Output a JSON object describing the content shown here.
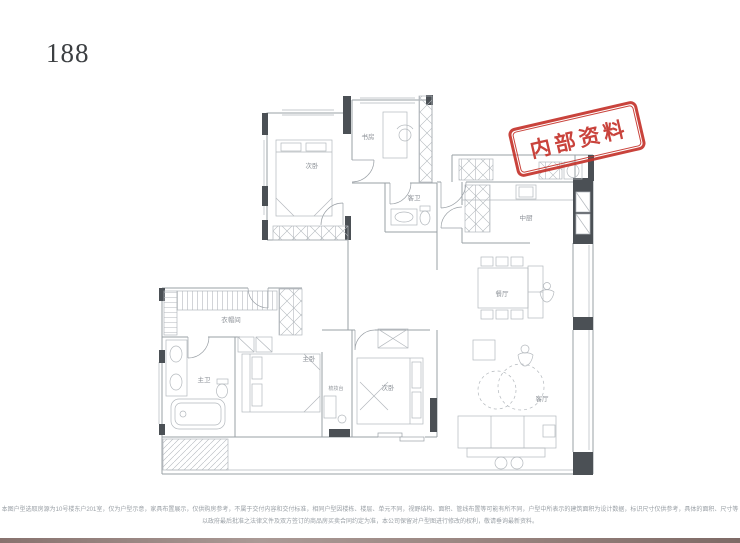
{
  "header": {
    "plan_number": "188"
  },
  "stamp": {
    "text": "内部资料",
    "color": "#c5342c"
  },
  "rooms": {
    "bedroom_top": "次卧",
    "study": "书房",
    "guest_bath": "客卫",
    "kitchen": "中厨",
    "dining": "餐厅",
    "cloakroom": "衣帽间",
    "master_bath": "主卫",
    "master_bedroom": "主卧",
    "dressing_table": "梳妆台",
    "bedroom_bottom": "次卧",
    "living": "客厅"
  },
  "disclaimer": {
    "line1": "本图户型选取房源为10号楼东户201室，仅为户型示意，家具布置展示，仅供购房参考，不属于交付内容和交付标准，相同户型因楼栋、楼层、单元不同，视野结构、面积、管线布置等可能有所不同，户型中所表示的建筑面积为设计数据，标识尺寸仅供参考，具体的面积、尺寸等",
    "line2": "以政府最后批准之法律文件及双方签订的商品房买卖合同约定为准，本公司保留对户型图进行修改的权利，敬请垂询最新资料。"
  },
  "colors": {
    "wall_gray": "#9aa0a6",
    "furniture_gray": "#b3b8bd",
    "solid_wall": "#4b5055",
    "stamp_red": "#c5342c",
    "label_gray": "#8d9298"
  }
}
